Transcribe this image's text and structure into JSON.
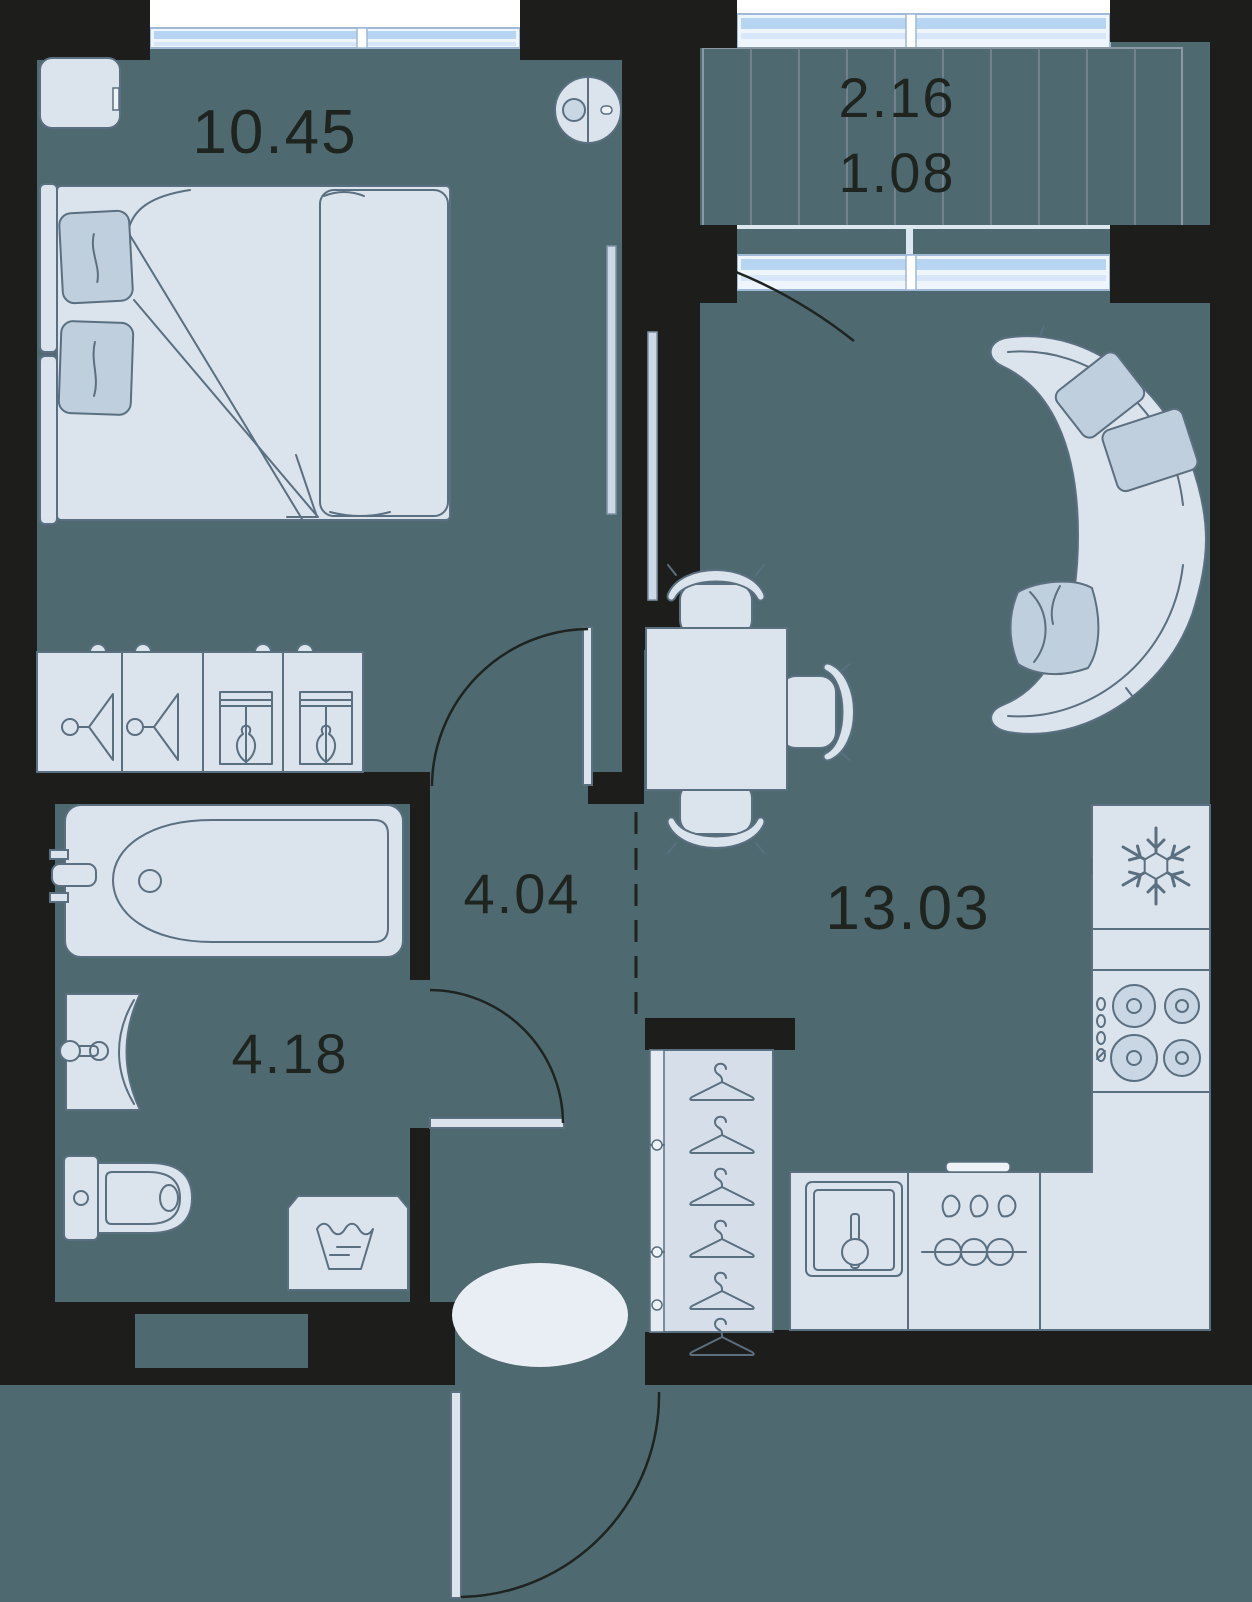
{
  "title": "Apartment floor plan",
  "rooms": {
    "bedroom": {
      "name": "bedroom",
      "label": "10.45"
    },
    "balcony": {
      "name": "balcony",
      "label_full": "2.16",
      "label_reduced": "1.08"
    },
    "kitchen_living": {
      "name": "kitchen-living",
      "label": "13.03"
    },
    "hallway": {
      "name": "hallway",
      "label": "4.04"
    },
    "bathroom": {
      "name": "bathroom",
      "label": "4.18"
    }
  },
  "furniture_icons": [
    "double-bed-icon",
    "pillow-icon",
    "nightstand-icon",
    "robot-vacuum-icon",
    "dresser-hanger-icon",
    "dresser-drawer-icon",
    "tv-icon",
    "curved-sofa-icon",
    "dining-table-icon",
    "chair-icon",
    "fridge-snowflake-icon",
    "stove-burners-icon",
    "kitchen-sink-icon",
    "dishwasher-icon",
    "bathtub-icon",
    "wash-basin-icon",
    "toilet-icon",
    "washing-machine-icon",
    "wardrobe-hanger-icon",
    "rug-icon",
    "door-swing-icon",
    "window-icon",
    "balcony-decking-icon"
  ],
  "colors": {
    "floor": "#4e6970",
    "wall": "#1d1d1b",
    "furniture_fill": "#dbe3ec",
    "furniture_stroke": "#5a6f80",
    "accent_pillow": "#c0cfdd",
    "window_blue": "#b7d4f2",
    "outside_white": "#ffffff",
    "label_text": "#1f241f",
    "door_line": "#1f2420",
    "rug": "#e9eef5"
  }
}
